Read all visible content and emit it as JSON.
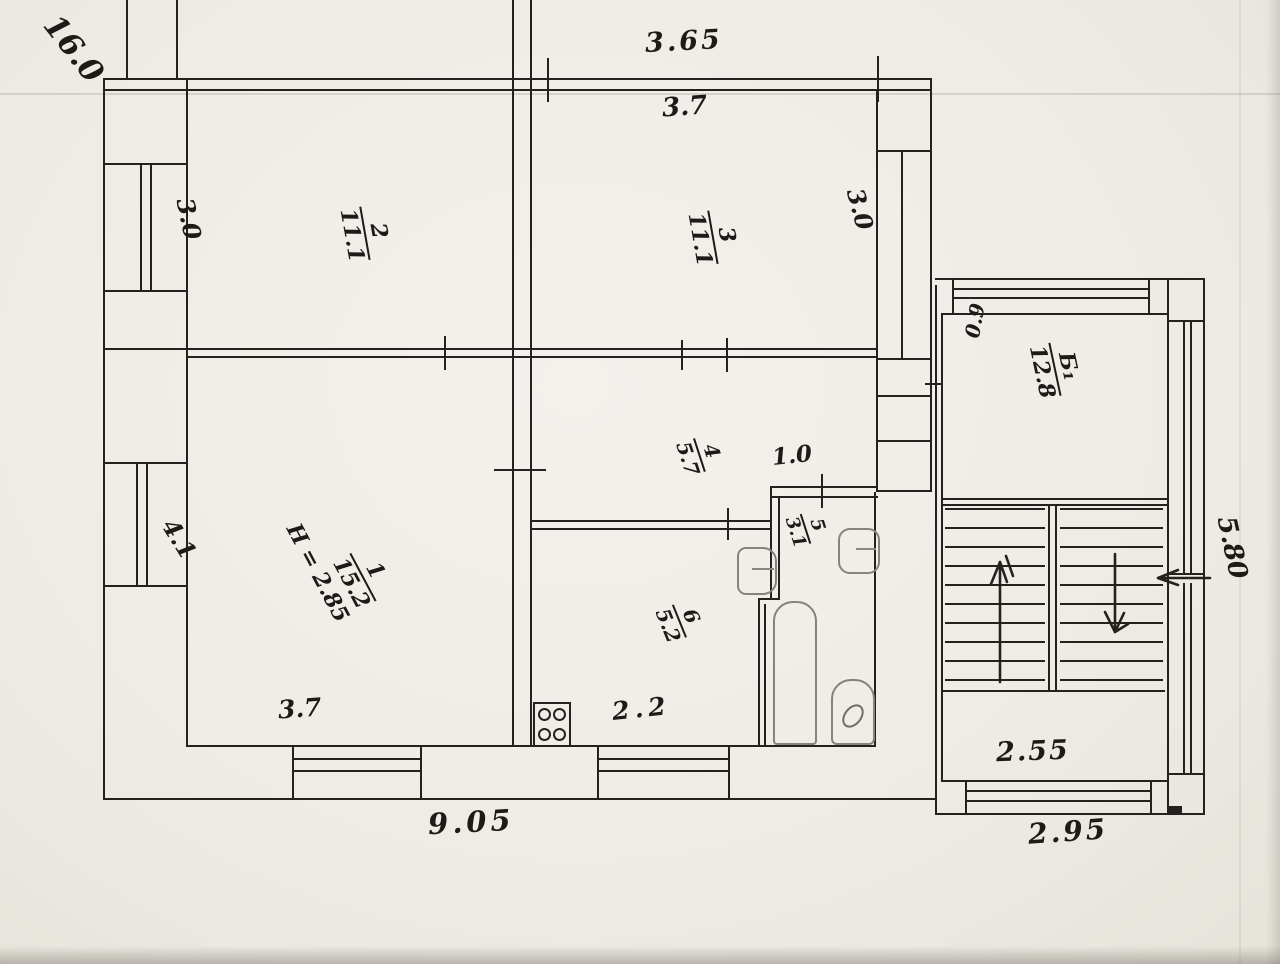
{
  "colors": {
    "ink": "#24221f",
    "paper": "#efece6",
    "fixture_gray": "#85837e"
  },
  "rooms": {
    "r1": {
      "num": "1",
      "area": "15.2"
    },
    "r2": {
      "num": "2",
      "area": "11.1"
    },
    "r3": {
      "num": "3",
      "area": "11.1"
    },
    "r4": {
      "num": "4",
      "area": "5.7"
    },
    "r5": {
      "num": "5",
      "area": "3.1"
    },
    "r6": {
      "num": "6",
      "area": "5.2"
    },
    "b1": {
      "num": "Б₁",
      "area": "12.8"
    }
  },
  "dims": {
    "plot_length": "16.0",
    "top_outer": "3.65",
    "top_inner": "3.7",
    "left_upper": "3.0",
    "right_upper": "3.0",
    "left_lower": "4.1",
    "stair_wall": "0.9",
    "right_height": "5.80",
    "bath_entry": "1.0",
    "ceiling_height": "H = 2.85",
    "room1_width": "3.7",
    "kitchen_width": "2.2",
    "bottom_main": "9.05",
    "stair_inner_width": "2.55",
    "stair_outer_width": "2.95"
  }
}
